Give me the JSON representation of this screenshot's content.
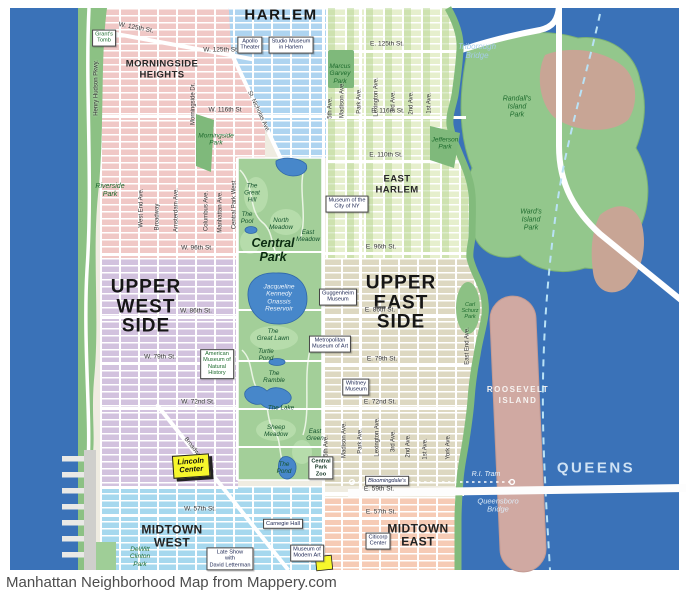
{
  "page": {
    "caption": "Manhattan Neighborhood Map from Mappery.com"
  },
  "colors": {
    "water": "#3a72b8",
    "park_green": "#a3cf99",
    "shore_green": "#82bb7c",
    "island_tan": "#c8a595",
    "roosevelt_island": "#d0a9a2",
    "harlem": "#aed4f0",
    "morningside": "#f0c8c6",
    "east_harlem": "#e6efcd",
    "upper_west_side": "#d2c2de",
    "upper_east_side": "#ddd8c1",
    "midtown_west": "#a6d8ee",
    "midtown_east": "#f6cbb5",
    "highlight_yellow": "#f7f72c",
    "boundary_dash": "#b9e2f6"
  },
  "map": {
    "labels": [
      {
        "n": "label-harlem",
        "t": "HARLEM",
        "x": 281,
        "y": 16,
        "c": "n2"
      },
      {
        "n": "label-morningside-heights",
        "t": "MORNINGSIDE\nHEIGHTS",
        "x": 162,
        "y": 70,
        "c": "n3"
      },
      {
        "n": "label-east-harlem",
        "t": "EAST\nHARLEM",
        "x": 397,
        "y": 185,
        "c": "n3"
      },
      {
        "n": "label-upper-west-side",
        "t": "UPPER\nWEST\nSIDE",
        "x": 146,
        "y": 307,
        "c": "n1"
      },
      {
        "n": "label-upper-east-side",
        "t": "UPPER\nEAST\nSIDE",
        "x": 401,
        "y": 303,
        "c": "n1"
      },
      {
        "n": "label-midtown-west",
        "t": "MIDTOWN\nWEST",
        "x": 172,
        "y": 537,
        "c": "n3b"
      },
      {
        "n": "label-midtown-east",
        "t": "MIDTOWN\nEAST",
        "x": 418,
        "y": 536,
        "c": "n3b"
      },
      {
        "n": "label-queens",
        "t": "QUEENS",
        "x": 596,
        "y": 469,
        "c": "qn"
      },
      {
        "n": "label-roosevelt-island",
        "t": "ROOSEVELT\nISLAND",
        "x": 518,
        "y": 396,
        "c": "isl"
      },
      {
        "n": "street-w125-diagonal",
        "t": "W. 125th St.",
        "x": 136,
        "y": 28,
        "c": "st",
        "r": 11
      },
      {
        "n": "street-w125",
        "t": "W. 125th St.",
        "x": 221,
        "y": 50,
        "c": "st"
      },
      {
        "n": "street-e125",
        "t": "E. 125th St.",
        "x": 387,
        "y": 44,
        "c": "st"
      },
      {
        "n": "street-w116",
        "t": "W. 116th St",
        "x": 225,
        "y": 110,
        "c": "st"
      },
      {
        "n": "street-e116",
        "t": "E. 116th St.",
        "x": 388,
        "y": 111,
        "c": "st"
      },
      {
        "n": "street-e110",
        "t": "E. 110th St.",
        "x": 386,
        "y": 155,
        "c": "st"
      },
      {
        "n": "street-w96",
        "t": "W. 96th St.",
        "x": 197,
        "y": 248,
        "c": "st"
      },
      {
        "n": "street-e96",
        "t": "E. 96th St.",
        "x": 381,
        "y": 247,
        "c": "st"
      },
      {
        "n": "street-w86",
        "t": "W. 86th St.",
        "x": 196,
        "y": 311,
        "c": "st"
      },
      {
        "n": "street-e86",
        "t": "E. 86th St.",
        "x": 380,
        "y": 310,
        "c": "st"
      },
      {
        "n": "street-w79",
        "t": "W. 79th St.",
        "x": 160,
        "y": 357,
        "c": "st"
      },
      {
        "n": "street-e79",
        "t": "E. 79th St.",
        "x": 382,
        "y": 359,
        "c": "st"
      },
      {
        "n": "street-w72",
        "t": "W. 72nd St.",
        "x": 198,
        "y": 402,
        "c": "st"
      },
      {
        "n": "street-e72",
        "t": "E. 72nd St.",
        "x": 380,
        "y": 402,
        "c": "st"
      },
      {
        "n": "street-e59",
        "t": "E. 59th St.",
        "x": 379,
        "y": 489,
        "c": "st"
      },
      {
        "n": "street-w57",
        "t": "W. 57th St.",
        "x": 200,
        "y": 509,
        "c": "st"
      },
      {
        "n": "street-e57",
        "t": "E. 57th St.",
        "x": 381,
        "y": 512,
        "c": "st"
      },
      {
        "n": "avenue-henry-hudson-pkwy",
        "t": "Henry Hudson Pkwy.",
        "x": 97,
        "y": 88,
        "c": "av",
        "r": -90
      },
      {
        "n": "avenue-west-end",
        "t": "West End Ave.",
        "x": 142,
        "y": 208,
        "c": "av",
        "r": -90
      },
      {
        "n": "avenue-broadway-upper",
        "t": "Broadway",
        "x": 158,
        "y": 217,
        "c": "av",
        "r": -90
      },
      {
        "n": "avenue-amsterdam",
        "t": "Amsterdam Ave.",
        "x": 177,
        "y": 210,
        "c": "av",
        "r": -90
      },
      {
        "n": "avenue-columbus",
        "t": "Columbus Ave.",
        "x": 207,
        "y": 211,
        "c": "av",
        "r": -90
      },
      {
        "n": "avenue-manhattan",
        "t": "Manhattan Ave.",
        "x": 221,
        "y": 212,
        "c": "av",
        "r": -90
      },
      {
        "n": "avenue-central-park-west",
        "t": "Central Park West",
        "x": 235,
        "y": 205,
        "c": "av",
        "r": -90
      },
      {
        "n": "avenue-morningside-dr",
        "t": "Morningside Dr.",
        "x": 194,
        "y": 104,
        "c": "av",
        "r": -90
      },
      {
        "n": "avenue-st-nicholas",
        "t": "St. Nicholas Ave.",
        "x": 258,
        "y": 112,
        "c": "av",
        "r": 65
      },
      {
        "n": "avenue-broadway-lower",
        "t": "Broadway",
        "x": 193,
        "y": 449,
        "c": "av",
        "r": 52
      },
      {
        "n": "avenue-5th-north",
        "t": "5th Ave.",
        "x": 331,
        "y": 108,
        "c": "av",
        "r": -90
      },
      {
        "n": "avenue-madison-north",
        "t": "Madison Ave.",
        "x": 343,
        "y": 100,
        "c": "av",
        "r": -90
      },
      {
        "n": "avenue-park-north",
        "t": "Park Ave.",
        "x": 360,
        "y": 101,
        "c": "av",
        "r": -90
      },
      {
        "n": "avenue-lexington-north",
        "t": "Lexington Ave.",
        "x": 377,
        "y": 97,
        "c": "av",
        "r": -90
      },
      {
        "n": "avenue-3rd-north",
        "t": "3rd Ave.",
        "x": 394,
        "y": 102,
        "c": "av",
        "r": -90
      },
      {
        "n": "avenue-2nd-north",
        "t": "2nd Ave.",
        "x": 412,
        "y": 103,
        "c": "av",
        "r": -90
      },
      {
        "n": "avenue-1st-north",
        "t": "1st Ave.",
        "x": 430,
        "y": 103,
        "c": "av",
        "r": -90
      },
      {
        "n": "avenue-5th-south",
        "t": "5th Ave.",
        "x": 327,
        "y": 446,
        "c": "av",
        "r": -90
      },
      {
        "n": "avenue-madison-south",
        "t": "Madison Ave.",
        "x": 345,
        "y": 440,
        "c": "av",
        "r": -90
      },
      {
        "n": "avenue-park-south",
        "t": "Park Ave.",
        "x": 361,
        "y": 441,
        "c": "av",
        "r": -90
      },
      {
        "n": "avenue-lexington-south",
        "t": "Lexington Ave.",
        "x": 378,
        "y": 437,
        "c": "av",
        "r": -90
      },
      {
        "n": "avenue-3rd-south",
        "t": "3rd Ave.",
        "x": 394,
        "y": 441,
        "c": "av",
        "r": -90
      },
      {
        "n": "avenue-2nd-south",
        "t": "2nd Ave.",
        "x": 409,
        "y": 446,
        "c": "av",
        "r": -90
      },
      {
        "n": "avenue-1st-south",
        "t": "1st Ave.",
        "x": 426,
        "y": 449,
        "c": "av",
        "r": -90
      },
      {
        "n": "avenue-york",
        "t": "York Ave.",
        "x": 449,
        "y": 447,
        "c": "av",
        "r": -90
      },
      {
        "n": "avenue-east-end",
        "t": "East End Ave.",
        "x": 468,
        "y": 346,
        "c": "av",
        "r": -90
      },
      {
        "n": "label-riverside-park",
        "t": "Riverside\nPark",
        "x": 110,
        "y": 191,
        "c": "pk"
      },
      {
        "n": "label-morningside-park",
        "t": "Morningside\nPark",
        "x": 216,
        "y": 140,
        "c": "pks"
      },
      {
        "n": "label-marcus-garvey-park",
        "t": "Marcus\nGarvey\nPark",
        "x": 340,
        "y": 74,
        "c": "pks"
      },
      {
        "n": "label-jefferson-park",
        "t": "Jefferson\nPark",
        "x": 445,
        "y": 144,
        "c": "pks"
      },
      {
        "n": "label-randalls-island-park",
        "t": "Randall's\nIsland\nPark",
        "x": 517,
        "y": 107,
        "c": "pk"
      },
      {
        "n": "label-wards-island-park",
        "t": "Ward's\nIsland\nPark",
        "x": 531,
        "y": 220,
        "c": "pk"
      },
      {
        "n": "label-carl-schurz-park",
        "t": "Carl\nSchurz\nPark",
        "x": 470,
        "y": 311,
        "c": "pkt"
      },
      {
        "n": "label-dewitt-clinton-park",
        "t": "DeWitt\nClinton\nPark",
        "x": 140,
        "y": 557,
        "c": "pks"
      },
      {
        "n": "label-central-park",
        "t": "Central\nPark",
        "x": 273,
        "y": 250,
        "c": "cpn"
      },
      {
        "n": "cp-great-hill",
        "t": "The\nGreat\nHill",
        "x": 252,
        "y": 193,
        "c": "cpf"
      },
      {
        "n": "cp-the-pool",
        "t": "The\nPool",
        "x": 247,
        "y": 218,
        "c": "cpf"
      },
      {
        "n": "cp-north-meadow",
        "t": "North\nMeadow",
        "x": 281,
        "y": 224,
        "c": "cpf"
      },
      {
        "n": "cp-east-meadow",
        "t": "East\nMeadow",
        "x": 308,
        "y": 236,
        "c": "cpf"
      },
      {
        "n": "cp-reservoir",
        "t": "Jacqueline\nKennedy\nOnassis\nReservoir",
        "x": 279,
        "y": 298,
        "c": "res"
      },
      {
        "n": "cp-great-lawn",
        "t": "The\nGreat Lawn",
        "x": 273,
        "y": 335,
        "c": "cpf"
      },
      {
        "n": "cp-turtle-pond",
        "t": "Turtle\nPond",
        "x": 266,
        "y": 355,
        "c": "cpf"
      },
      {
        "n": "cp-the-ramble",
        "t": "The\nRamble",
        "x": 274,
        "y": 377,
        "c": "cpf"
      },
      {
        "n": "cp-the-lake",
        "t": "The Lake",
        "x": 281,
        "y": 408,
        "c": "cpf"
      },
      {
        "n": "cp-sheep-meadow",
        "t": "Sheep\nMeadow",
        "x": 276,
        "y": 431,
        "c": "cpf"
      },
      {
        "n": "cp-east-green",
        "t": "East\nGreen",
        "x": 315,
        "y": 435,
        "c": "cpf"
      },
      {
        "n": "cp-the-pond",
        "t": "The\nPond",
        "x": 284,
        "y": 468,
        "c": "cpf"
      },
      {
        "n": "landmark-grants-tomb",
        "t": "Grant's\nTomb",
        "x": 104,
        "y": 38,
        "c": "bxg"
      },
      {
        "n": "landmark-apollo-theater",
        "t": "Apollo\nTheater",
        "x": 250,
        "y": 45,
        "c": "bx"
      },
      {
        "n": "landmark-studio-museum",
        "t": "Studio Museum\nin Harlem",
        "x": 291,
        "y": 45,
        "c": "bx"
      },
      {
        "n": "landmark-museum-city-ny",
        "t": "Museum of the\nCity of NY",
        "x": 347,
        "y": 204,
        "c": "bx"
      },
      {
        "n": "landmark-guggenheim",
        "t": "Guggenheim\nMuseum",
        "x": 338,
        "y": 297,
        "c": "bx"
      },
      {
        "n": "landmark-met",
        "t": "Metropolitan\nMuseum of Art",
        "x": 330,
        "y": 344,
        "c": "bx"
      },
      {
        "n": "landmark-whitney",
        "t": "Whitney\nMuseum",
        "x": 356,
        "y": 387,
        "c": "bx"
      },
      {
        "n": "landmark-amnh",
        "t": "American\nMuseum of\nNatural\nHistory",
        "x": 217,
        "y": 364,
        "c": "bxg"
      },
      {
        "n": "landmark-bloomingdales",
        "t": "Bloomingdale's",
        "x": 387,
        "y": 481,
        "c": "bxi"
      },
      {
        "n": "landmark-carnegie-hall",
        "t": "Carnegie Hall",
        "x": 283,
        "y": 524,
        "c": "bx"
      },
      {
        "n": "landmark-late-show",
        "t": "Late Show\nwith\nDavid Letterman",
        "x": 230,
        "y": 559,
        "c": "bx"
      },
      {
        "n": "landmark-moma",
        "t": "Museum of\nModern Art",
        "x": 307,
        "y": 553,
        "c": "bx"
      },
      {
        "n": "landmark-citicorp",
        "t": "Citicorp\nCenter",
        "x": 378,
        "y": 541,
        "c": "bx"
      },
      {
        "n": "landmark-central-park-zoo",
        "t": "Central\nPark\nZoo",
        "x": 321,
        "y": 468,
        "c": "bxb"
      },
      {
        "n": "landmark-lincoln-center",
        "t": "Lincoln\nCenter",
        "x": 191,
        "y": 466,
        "c": "lc",
        "r": -4
      },
      {
        "n": "label-triborough-bridge",
        "t": "Triborough\nBridge",
        "x": 477,
        "y": 52,
        "c": "wt"
      },
      {
        "n": "label-queensboro-bridge",
        "t": "Queensboro\nBridge",
        "x": 498,
        "y": 506,
        "c": "ww"
      },
      {
        "n": "label-ri-tram",
        "t": "R.I. Tram",
        "x": 486,
        "y": 475,
        "c": "ww2"
      }
    ]
  }
}
